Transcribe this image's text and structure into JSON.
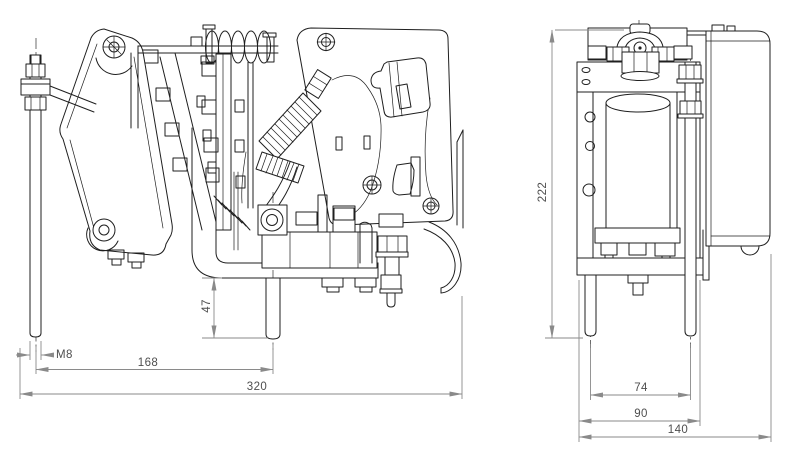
{
  "drawing": {
    "side_view": {
      "dimensions": {
        "thread": "M8",
        "mounting_span": "168",
        "overall_width": "320",
        "stud_projection": "47"
      }
    },
    "front_view": {
      "dimensions": {
        "overall_height": "222",
        "stud_spacing": "74",
        "frame_width": "90",
        "overall_depth": "140"
      }
    },
    "colors": {
      "background": "#ffffff",
      "outline": "#1f1f1f",
      "dimension_lines": "#8a8a8a",
      "dimension_text": "#4e4e4e"
    }
  }
}
